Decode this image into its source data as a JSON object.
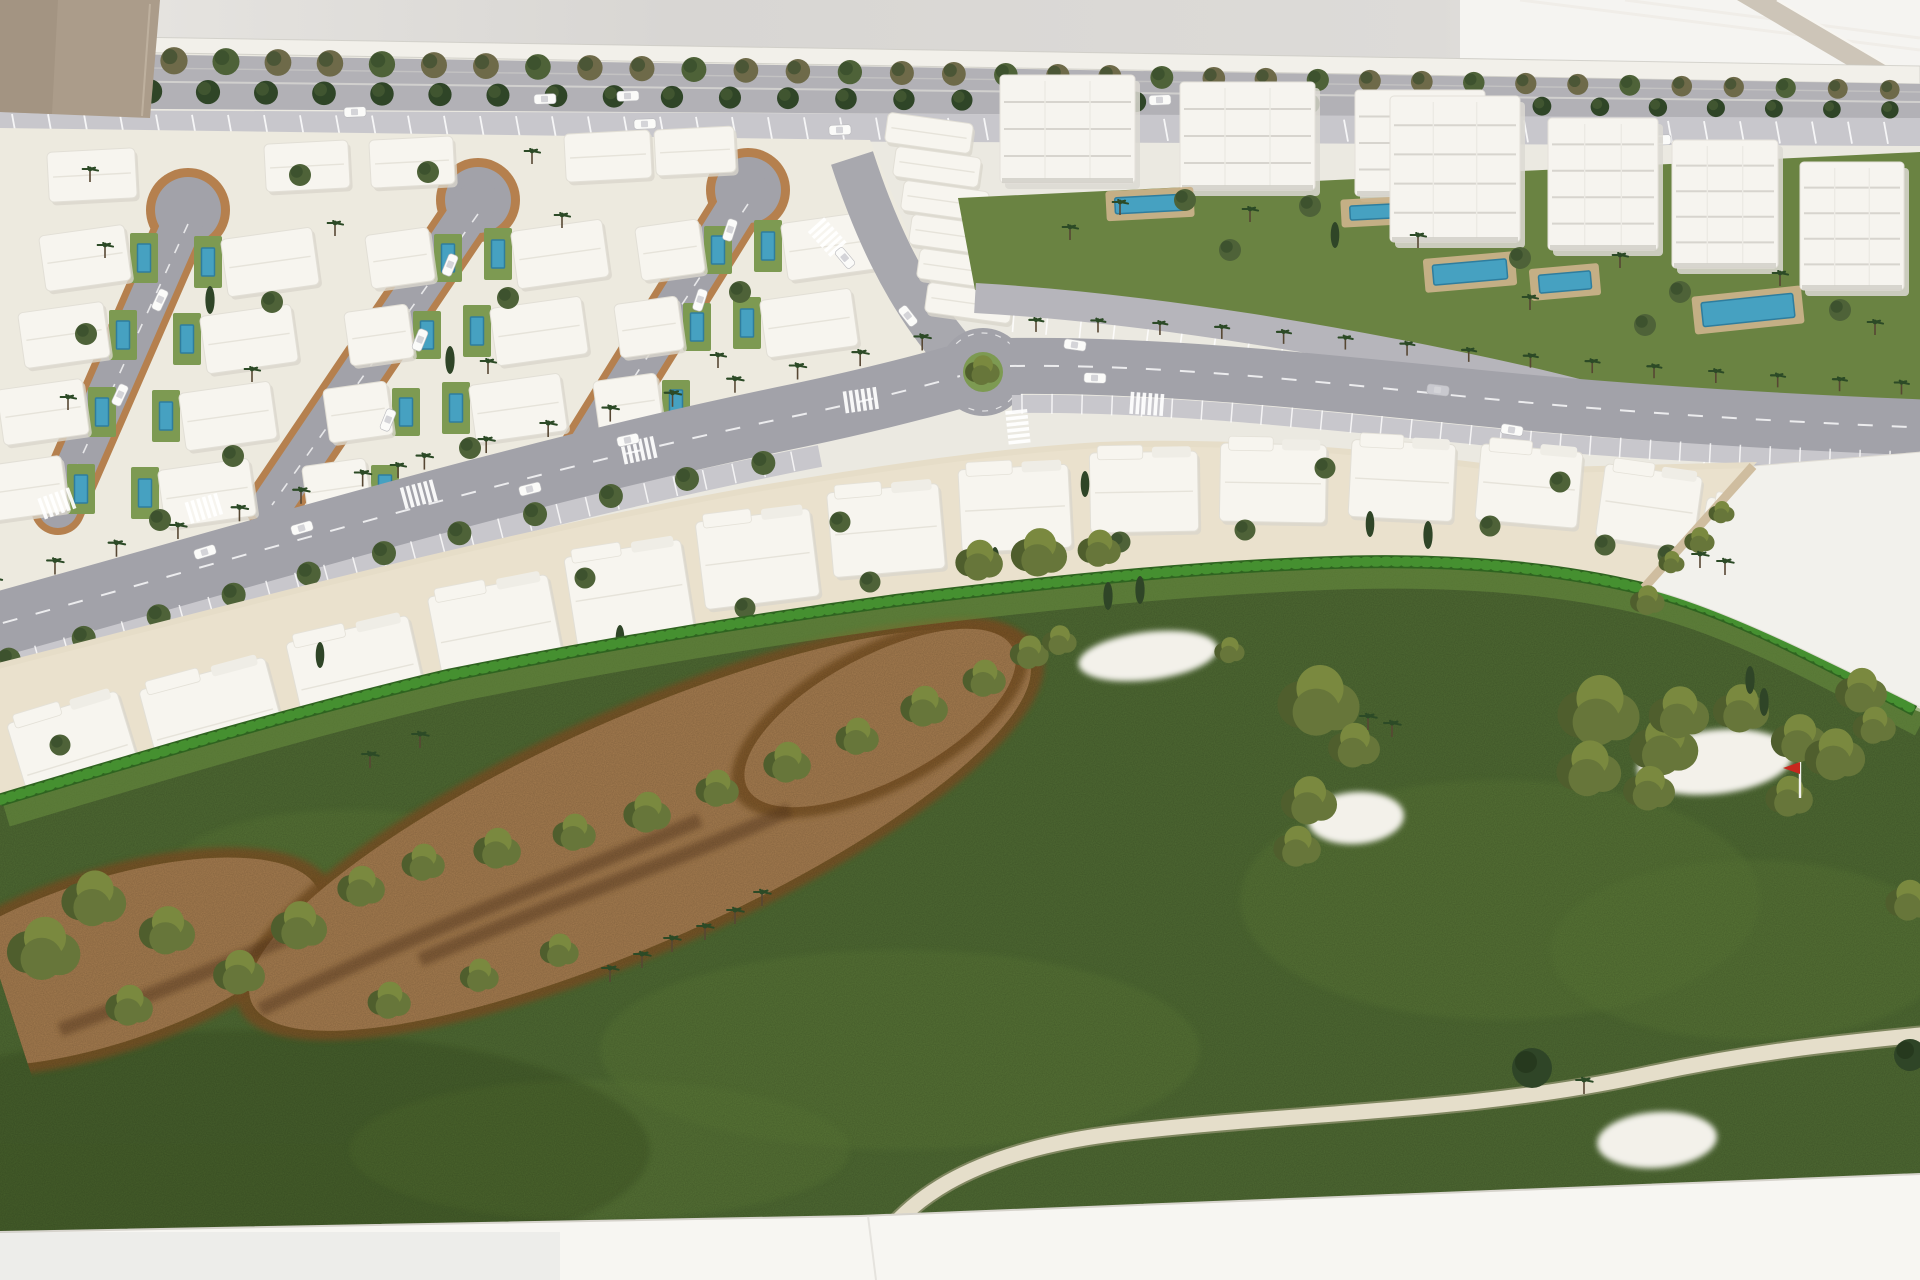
{
  "meta": {
    "scene": "architectural-scale-model-aerial",
    "content": "white resort masterplan model with villas, apartment blocks, boulevard, roundabout and golf course"
  },
  "colors": {
    "wall": "#d8d6d3",
    "wallLeft": "#e9e7e3",
    "wallBright": "#f5f4f1",
    "beam": "#cdc5b8",
    "beamLine": "#efece6",
    "tanBox": "#ab9c8a",
    "tanBoxDark": "#9c8e7c",
    "edgeStrip": "#f2f0ea",
    "modelBase": "#ebe9e1",
    "avenueRoad": "#b2b1b6",
    "parking": "#c8c7cc",
    "roadMark": "#ffffff",
    "boulevard": "#a2a2a9",
    "serviceRoad": "#b6b5bb",
    "verticalRoad": "#a8a8ae",
    "villaGround": "#edeadf",
    "villa": "#f7f5ef",
    "villaShade": "#d9d6cc",
    "tanEdge": "#b5804e",
    "lawn": "#7d9a52",
    "pool": "#46a1c1",
    "poolDark": "#2e7d9e",
    "deck": "#c9b189",
    "aptLawn": "#6a8342",
    "block": "#f6f4ef",
    "blockLine": "#d7d4ce",
    "blockSide": "#dcd9d2",
    "beige": "#e6ddc8",
    "beigeLight": "#efe8d5",
    "grass": "#4f6a33",
    "grassLight": "#5c7939",
    "lawnBright": "#699040",
    "dirt": "#a57c4f",
    "dirtEdge": "#7c5527",
    "dirtDeep": "#59371a",
    "hedge": "#2f6420",
    "hedge2": "#459030",
    "bush": "#67763a",
    "bushDark": "#4f5e2d",
    "bushLight": "#7a893f",
    "treeDark": "#2f4527",
    "treeOlive": "#4e6238",
    "treeBrown": "#6e6a49",
    "palm": "#2c4a26",
    "trunk": "#574733",
    "bunker": "#f3f1ea",
    "cartPath": "#e5deca",
    "flag": "#c8281e",
    "car": "#fbfbf9",
    "carGray": "#c9c9cf",
    "base": "#f7f6f2",
    "seam": "#d6d3cc"
  },
  "geometry": {
    "modelBase": "M 0 42 L 1920 70 L 1920 1180 L 860 1216 L 0 1232 Z",
    "edgeStrip": "M 0 35 L 1920 66 L 1920 84 L 0 50 Z",
    "wallBright": "M 1460 0 L 1920 0 L 1920 66 L 1460 58 Z",
    "beam": "M 1737 0 L 1777 0 L 1920 84 L 1920 108 Z",
    "beamLines": [
      [
        1520,
        0,
        1920,
        50
      ],
      [
        1625,
        0,
        1920,
        38
      ]
    ],
    "tanBox": "M 0 0 L 160 0 L 150 118 L 0 112 Z",
    "avenueRoadBand": "M 0 52 L 1920 84 L 1920 120 L 0 108 Z",
    "parkingBand": "M 0 110 L 1920 118 L 1920 146 L 0 138 Z",
    "villaGround": "M 0 128 L 870 140 L 960 360 L 820 400 L 520 468 L 200 540 L 0 600 Z",
    "aptLawn": "M 958 198 L 1920 152 L 1920 452 L 1757 462 C 1690 428 1600 398 1500 376 C 1340 346 1150 314 975 290 Z",
    "boulevardLeft": "M -30 632 C 250 555 520 472 800 415 C 880 398 928 385 960 376",
    "boulevardRight": "M 1010 366 C 1160 364 1320 382 1480 398 C 1620 412 1780 422 1935 428",
    "boulevardLowerParkLeft": "M -30 674 C 250 597 520 514 820 456",
    "boulevardLowerParkRight": "M 1012 404 C 1160 402 1320 420 1480 436 C 1620 450 1780 458 1935 462",
    "palmRowLeft": "M -20 596 C 250 519 520 436 800 379 C 870 365 920 352 950 342",
    "palmRowRight": "M 1030 332 C 1170 330 1330 348 1490 364 C 1630 377 1790 390 1935 396",
    "lowerTreeRowLeft": "M -20 668 C 250 590 520 508 830 450",
    "verticalRoad": "M 852 158 C 872 220 902 292 954 352",
    "serviceLane": "M 975 298 C 1150 308 1350 342 1520 380 C 1650 410 1760 445 1822 492 C 1862 525 1876 556 1878 606",
    "avenueTreeRow1": "M 10 58 L 1910 90",
    "avenueTreeRow2": "M 10 90 L 1905 110",
    "bandGround": "M -10 665 C 250 600 500 532 750 487 C 900 462 1000 448 1100 442 C 1250 436 1400 452 1520 468 L 1757 462 L 1644 589 C 1500 565 1350 562 1200 566 C 1050 580 900 602 750 627 C 600 657 450 692 300 737 C 150 812 50 852 -10 872 Z",
    "golf": "M 0 800 C 150 755 300 710 450 675 C 600 645 750 620 900 600 C 1050 582 1200 566 1350 562 C 1450 560 1550 566 1644 589 C 1730 610 1820 660 1915 710 L 1920 712 L 1920 1176 L 860 1216 L 0 1232 Z",
    "hedge": "M 0 800 C 150 755 300 710 450 675 C 600 645 750 620 900 600 C 1050 582 1200 566 1350 562 C 1450 560 1550 566 1644 589 C 1730 610 1820 660 1915 710",
    "whitePlot": "M 1753 466 L 1922 452 L 1922 708 C 1830 662 1720 606 1644 588 Z",
    "plotPath": "M 1753 466 L 1644 588",
    "dirtMain": {
      "cx": 640,
      "cy": 830,
      "rx": 425,
      "ry": 112,
      "rot": -24
    },
    "dirtLeft": {
      "cx": 105,
      "cy": 962,
      "rx": 225,
      "ry": 82,
      "rot": -18
    },
    "dirtTongue": {
      "cx": 880,
      "cy": 718,
      "rx": 150,
      "ry": 62,
      "rot": -28
    },
    "dirtStreaks": [
      "M 260 1010 C 420 930 560 880 700 820",
      "M 60 1030 C 160 992 240 958 310 928",
      "M 420 960 C 560 900 680 860 790 810"
    ],
    "cartPath": "M 852 1292 C 890 1195 980 1150 1120 1133 C 1300 1112 1470 1112 1640 1076 C 1760 1050 1850 1042 1930 1034",
    "grassPatches": [
      [
        1500,
        900,
        260,
        120
      ],
      [
        900,
        1050,
        300,
        100
      ],
      [
        1750,
        950,
        200,
        90
      ],
      [
        600,
        1150,
        250,
        70
      ],
      [
        350,
        870,
        180,
        60
      ]
    ],
    "bunkers": [
      [
        1148,
        656,
        70,
        24,
        -7
      ],
      [
        1356,
        818,
        48,
        26,
        -4
      ],
      [
        1715,
        762,
        78,
        32,
        -6
      ],
      [
        1657,
        1140,
        60,
        28,
        -4
      ]
    ],
    "flag": {
      "x": 1800,
      "y": 798
    }
  },
  "streets": [
    {
      "bx": 188,
      "by": 210,
      "ex": 58,
      "ey": 508
    },
    {
      "bx": 478,
      "by": 200,
      "ex": 272,
      "ey": 505
    },
    {
      "bx": 748,
      "by": 190,
      "ex": 585,
      "ey": 452
    }
  ],
  "villasRow0": [
    [
      48,
      150,
      88,
      50
    ],
    [
      265,
      142,
      84,
      48
    ],
    [
      370,
      138,
      84,
      48
    ],
    [
      565,
      132,
      86,
      48
    ],
    [
      655,
      128,
      80,
      46
    ]
  ],
  "villaCols": [
    {
      "x": 85,
      "y": 258,
      "side": 1,
      "rows": 4,
      "w": 86,
      "h": 56
    },
    {
      "x": 270,
      "y": 262,
      "side": -1,
      "rows": 4,
      "w": 92,
      "h": 58
    },
    {
      "x": 400,
      "y": 258,
      "side": 1,
      "rows": 4,
      "w": 64,
      "h": 54
    },
    {
      "x": 560,
      "y": 254,
      "side": -1,
      "rows": 3,
      "w": 92,
      "h": 58
    },
    {
      "x": 670,
      "y": 250,
      "side": 1,
      "rows": 3,
      "w": 64,
      "h": 54
    },
    {
      "x": 830,
      "y": 246,
      "side": -1,
      "rows": 2,
      "w": 92,
      "h": 58
    }
  ],
  "villaTrees": [
    [
      "p",
      105,
      258
    ],
    [
      "t",
      86,
      334
    ],
    [
      "p",
      68,
      410
    ],
    [
      "t",
      272,
      302
    ],
    [
      "p",
      252,
      382
    ],
    [
      "t",
      233,
      456
    ],
    [
      "p",
      335,
      236
    ],
    [
      "t",
      508,
      298
    ],
    [
      "p",
      488,
      374
    ],
    [
      "t",
      470,
      448
    ],
    [
      "p",
      562,
      228
    ],
    [
      "t",
      740,
      292
    ],
    [
      "p",
      718,
      368
    ],
    [
      "c",
      210,
      300
    ],
    [
      "c",
      450,
      360
    ],
    [
      "t",
      300,
      175
    ],
    [
      "p",
      532,
      164
    ],
    [
      "t",
      160,
      520
    ],
    [
      "p",
      398,
      478
    ],
    [
      "t",
      615,
      440
    ],
    [
      "p",
      90,
      182
    ],
    [
      "t",
      428,
      172
    ]
  ],
  "stemCars": [
    [
      160,
      300,
      115
    ],
    [
      120,
      395,
      115
    ],
    [
      450,
      265,
      112
    ],
    [
      420,
      340,
      112
    ],
    [
      388,
      420,
      112
    ],
    [
      730,
      230,
      108
    ],
    [
      700,
      300,
      108
    ]
  ],
  "terraceUnits": {
    "list": [
      [
        886,
        118
      ],
      [
        894,
        152
      ],
      [
        902,
        186
      ],
      [
        910,
        220
      ],
      [
        918,
        254
      ],
      [
        926,
        288
      ]
    ],
    "w": 86,
    "h": 30,
    "rot": 8
  },
  "blocksA": [
    [
      1000,
      75,
      135,
      108
    ],
    [
      1180,
      82,
      135,
      108
    ],
    [
      1355,
      90,
      130,
      106
    ]
  ],
  "blocksB": [
    [
      1390,
      96,
      130,
      146
    ],
    [
      1548,
      118,
      110,
      132
    ],
    [
      1672,
      140,
      106,
      128
    ],
    [
      1800,
      162,
      104,
      128
    ]
  ],
  "aptPools": [
    [
      1150,
      204,
      70,
      16,
      -3
    ],
    [
      1372,
      212,
      44,
      14,
      -3
    ],
    [
      1470,
      272,
      74,
      20,
      -5
    ],
    [
      1565,
      282,
      52,
      18,
      -5
    ],
    [
      1748,
      310,
      92,
      24,
      -6
    ]
  ],
  "aptTrees": [
    [
      "p",
      1120,
      215
    ],
    [
      "t",
      1185,
      200
    ],
    [
      "p",
      1250,
      222
    ],
    [
      "t",
      1310,
      206
    ],
    [
      "p",
      1418,
      248
    ],
    [
      "t",
      1520,
      258
    ],
    [
      "p",
      1620,
      268
    ],
    [
      "t",
      1680,
      292
    ],
    [
      "p",
      1780,
      286
    ],
    [
      "t",
      1840,
      310
    ],
    [
      "p",
      1070,
      240
    ],
    [
      "t",
      1230,
      250
    ],
    [
      "c",
      1335,
      235
    ],
    [
      "p",
      1530,
      310
    ],
    [
      "t",
      1645,
      325
    ],
    [
      "p",
      1875,
      335
    ]
  ],
  "parkedCars": [
    [
      355,
      112,
      -2
    ],
    [
      645,
      124,
      -2
    ],
    [
      840,
      130,
      -2
    ],
    [
      1035,
      128,
      -2
    ],
    [
      1660,
      140,
      -2
    ]
  ],
  "avenueCars": [
    [
      545,
      99,
      -2
    ],
    [
      628,
      96,
      -2
    ],
    [
      1160,
      100,
      -2
    ]
  ],
  "roadCars": [
    [
      205,
      552,
      -17
    ],
    [
      302,
      528,
      -16
    ],
    [
      628,
      440,
      -12
    ],
    [
      1095,
      378,
      2
    ],
    [
      1438,
      390,
      7,
      "gray"
    ],
    [
      1512,
      430,
      9
    ],
    [
      845,
      258,
      50
    ],
    [
      908,
      316,
      52
    ],
    [
      1075,
      345,
      8
    ],
    [
      530,
      489,
      -14
    ]
  ],
  "roundabout": {
    "x": 983,
    "y": 372,
    "r": 44
  },
  "crosswalks": [
    [
      58,
      503,
      -20
    ],
    [
      205,
      508,
      -17
    ],
    [
      420,
      494,
      -15
    ],
    [
      640,
      450,
      -12
    ],
    [
      862,
      400,
      -8
    ],
    [
      1148,
      404,
      4
    ],
    [
      1018,
      428,
      84
    ],
    [
      828,
      238,
      48
    ]
  ],
  "townhouses": [
    [
      20,
      705,
      115,
      110,
      -17
    ],
    [
      150,
      672,
      130,
      105,
      -15
    ],
    [
      295,
      628,
      125,
      98,
      -13
    ],
    [
      435,
      585,
      122,
      94,
      -11
    ],
    [
      570,
      548,
      118,
      90,
      -9
    ],
    [
      700,
      515,
      115,
      88,
      -7
    ],
    [
      830,
      488,
      112,
      85,
      -5
    ],
    [
      960,
      467,
      110,
      83,
      -3
    ],
    [
      1090,
      452,
      108,
      80,
      -1
    ],
    [
      1220,
      444,
      106,
      78,
      1
    ],
    [
      1350,
      442,
      104,
      77,
      3
    ],
    [
      1478,
      448,
      102,
      76,
      5
    ],
    [
      1600,
      470,
      98,
      74,
      8
    ],
    [
      1700,
      505,
      94,
      72,
      11
    ],
    [
      0,
      800,
      85,
      72,
      -18
    ]
  ],
  "gardenTrees": [
    [
      "t",
      95,
      815
    ],
    [
      "c",
      230,
      760
    ],
    [
      "t",
      360,
      715
    ],
    [
      "t",
      490,
      675
    ],
    [
      "c",
      620,
      638
    ],
    [
      "t",
      745,
      608
    ],
    [
      "t",
      870,
      582
    ],
    [
      "c",
      995,
      560
    ],
    [
      "t",
      1120,
      542
    ],
    [
      "t",
      1245,
      530
    ],
    [
      "c",
      1370,
      524
    ],
    [
      "t",
      1490,
      526
    ],
    [
      "t",
      1605,
      545
    ],
    [
      "t",
      60,
      745
    ],
    [
      "c",
      320,
      655
    ],
    [
      "t",
      585,
      578
    ],
    [
      "t",
      840,
      522
    ],
    [
      "c",
      1085,
      484
    ],
    [
      "t",
      1325,
      468
    ],
    [
      "t",
      1560,
      482
    ],
    [
      "t",
      1668,
      555
    ],
    [
      "c",
      1710,
      528
    ],
    [
      "t",
      1738,
      505
    ]
  ],
  "golfBushes": [
    [
      300,
      925,
      26
    ],
    [
      362,
      886,
      22
    ],
    [
      424,
      862,
      20
    ],
    [
      498,
      848,
      22
    ],
    [
      575,
      832,
      20
    ],
    [
      648,
      812,
      22
    ],
    [
      718,
      788,
      20
    ],
    [
      788,
      762,
      22
    ],
    [
      858,
      736,
      20
    ],
    [
      925,
      706,
      22
    ],
    [
      985,
      678,
      20
    ],
    [
      1030,
      652,
      18
    ],
    [
      240,
      972,
      24
    ],
    [
      168,
      930,
      26
    ],
    [
      95,
      898,
      30
    ],
    [
      45,
      948,
      34
    ],
    [
      130,
      1005,
      22
    ],
    [
      390,
      1000,
      20
    ],
    [
      480,
      975,
      18
    ],
    [
      560,
      950,
      18
    ],
    [
      980,
      560,
      22
    ],
    [
      1040,
      552,
      26
    ],
    [
      1100,
      548,
      20
    ],
    [
      1320,
      700,
      38
    ],
    [
      1355,
      745,
      24
    ],
    [
      1310,
      800,
      26
    ],
    [
      1298,
      846,
      22
    ],
    [
      1600,
      710,
      38
    ],
    [
      1590,
      768,
      30
    ],
    [
      1665,
      745,
      32
    ],
    [
      1650,
      788,
      24
    ],
    [
      1680,
      712,
      28
    ],
    [
      1742,
      708,
      26
    ],
    [
      1800,
      738,
      26
    ],
    [
      1836,
      754,
      28
    ],
    [
      1790,
      796,
      22
    ],
    [
      1862,
      690,
      24
    ],
    [
      1910,
      900,
      22
    ],
    [
      1875,
      725,
      20
    ],
    [
      1060,
      640,
      16
    ],
    [
      1230,
      650,
      14
    ]
  ],
  "golfPalms": [
    [
      370,
      768
    ],
    [
      420,
      748
    ],
    [
      705,
      940
    ],
    [
      735,
      924
    ],
    [
      762,
      906
    ],
    [
      672,
      952
    ],
    [
      642,
      968
    ],
    [
      610,
      982
    ],
    [
      1368,
      730
    ],
    [
      1392,
      737
    ],
    [
      1700,
      568
    ],
    [
      1725,
      575
    ],
    [
      1584,
      1094
    ]
  ],
  "golfCypress": [
    [
      1428,
      535
    ],
    [
      1750,
      680
    ],
    [
      1764,
      702
    ],
    [
      1108,
      596
    ],
    [
      1140,
      590
    ]
  ],
  "golfTrees": [
    [
      1532,
      1068,
      20
    ],
    [
      1910,
      1055,
      16
    ]
  ],
  "plotBushes": [
    [
      1700,
      540,
      14
    ],
    [
      1672,
      562,
      12
    ],
    [
      1722,
      512,
      12
    ],
    [
      1648,
      600,
      16
    ]
  ],
  "rows": {
    "avenue1": {
      "step": 52,
      "type": "t",
      "r": 14
    },
    "avenue2": {
      "step": 58,
      "type": "t",
      "r": 12
    },
    "palmL": {
      "step": 64,
      "type": "p",
      "s": 14
    },
    "palmR": {
      "step": 62,
      "type": "p",
      "s": 12
    },
    "lowTrees": {
      "step": 78,
      "type": "t",
      "r": 12
    }
  }
}
